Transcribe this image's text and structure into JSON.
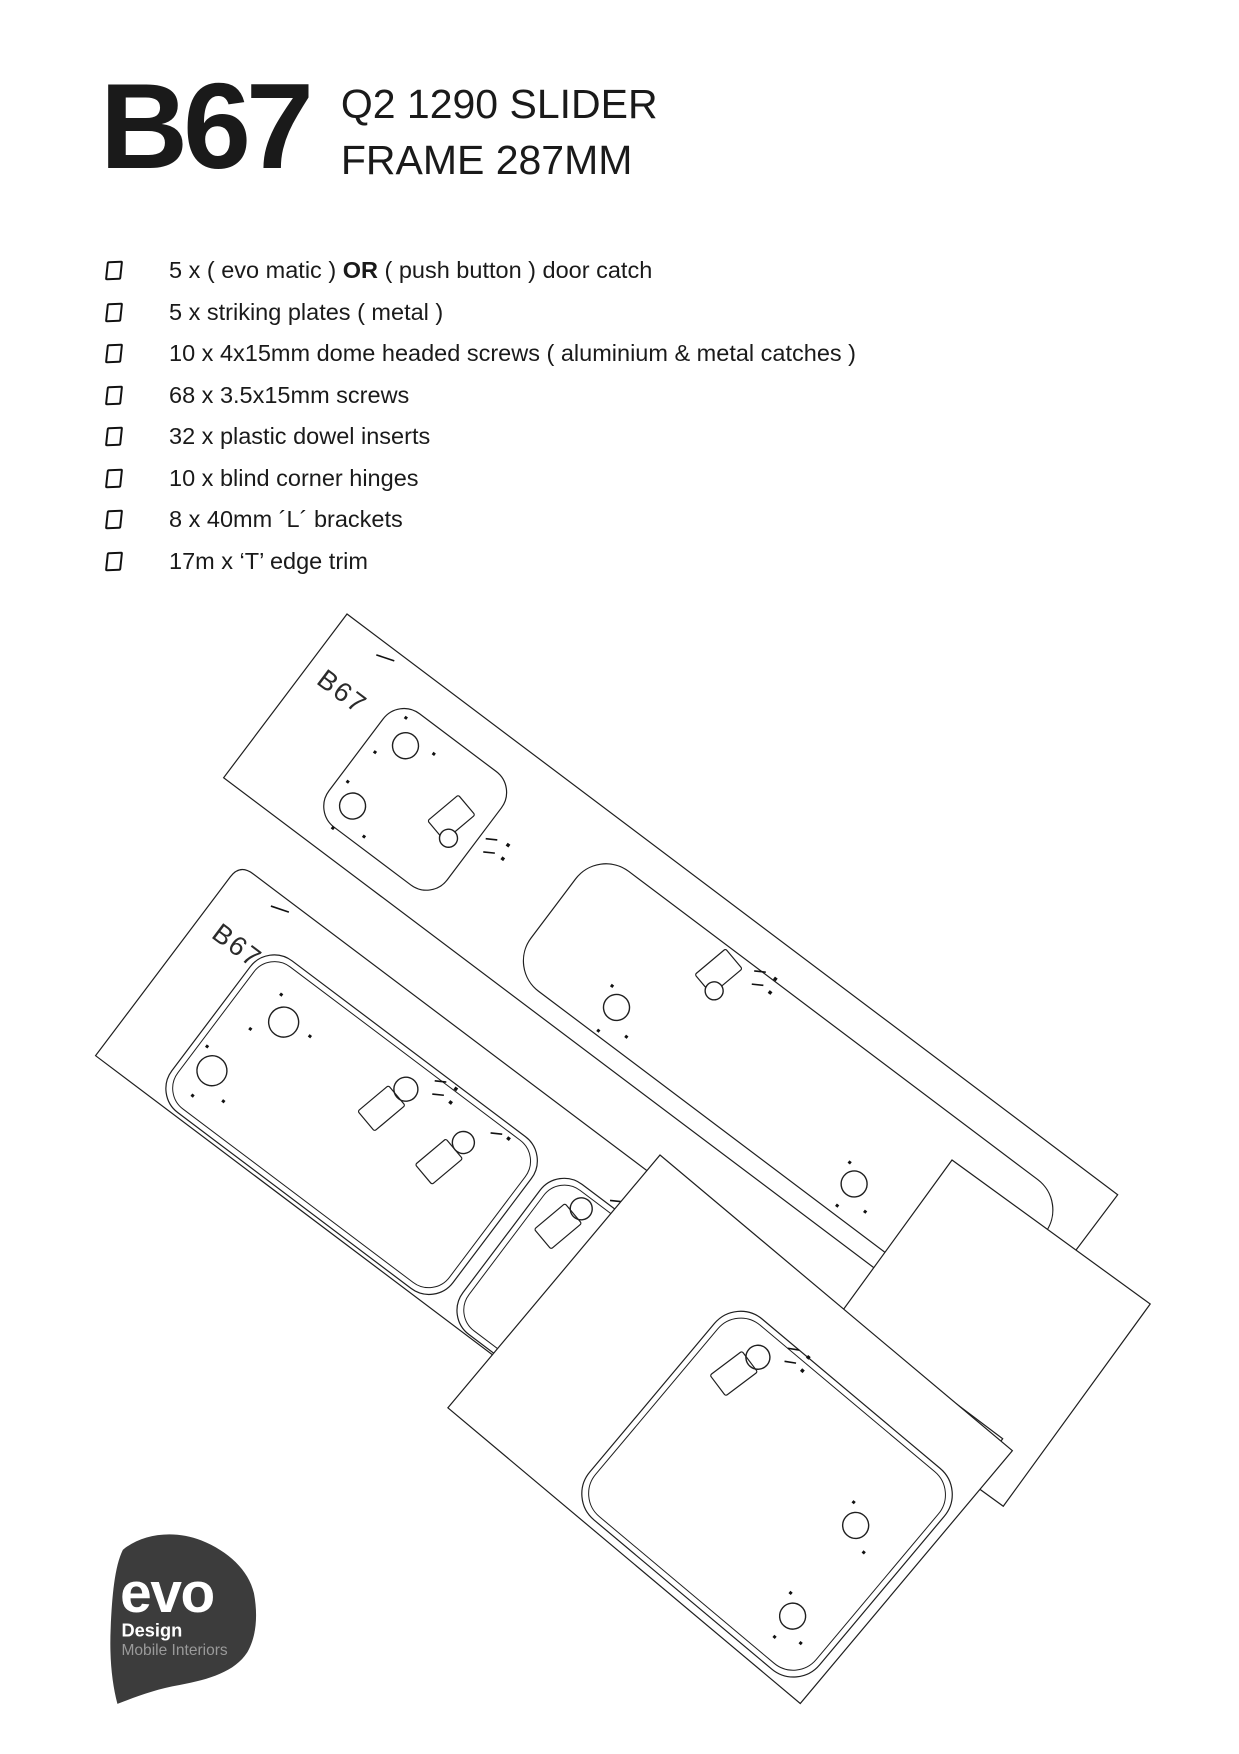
{
  "page": {
    "title_code": "B67",
    "subtitle_line1": "Q2 1290 SLIDER",
    "subtitle_line2": "FRAME 287MM"
  },
  "checklist": {
    "items": [
      {
        "pre": "5 x ( evo matic ) ",
        "bold": "OR",
        "post": " ( push button ) door catch"
      },
      {
        "pre": "5 x striking plates ( metal )",
        "bold": "",
        "post": ""
      },
      {
        "pre": "10 x 4x15mm dome headed screws ( aluminium & metal catches )",
        "bold": "",
        "post": ""
      },
      {
        "pre": "68 x 3.5x15mm screws",
        "bold": "",
        "post": ""
      },
      {
        "pre": "32 x plastic dowel inserts",
        "bold": "",
        "post": ""
      },
      {
        "pre": "10 x blind corner hinges",
        "bold": "",
        "post": ""
      },
      {
        "pre": "8 x 40mm ´L´ brackets",
        "bold": "",
        "post": ""
      },
      {
        "pre": "17m x ‘T’ edge trim",
        "bold": "",
        "post": ""
      }
    ]
  },
  "drawing": {
    "label_strip1": "B67",
    "label_strip2": "B67"
  },
  "logo": {
    "brand": "evo",
    "line1": "Design",
    "line2": "Mobile Interiors"
  },
  "colors": {
    "text": "#1a1a1a",
    "line": "#1f1f1f",
    "logo_bg": "#3c3c3c",
    "logo_sub": "#9a9a9a"
  }
}
